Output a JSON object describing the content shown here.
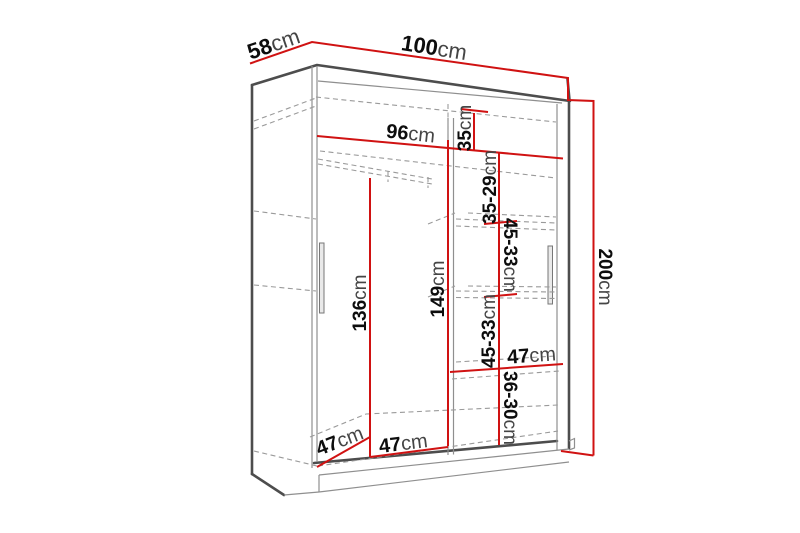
{
  "diagram": {
    "kind": "wardrobe-dimension-drawing",
    "unit": "cm",
    "colors": {
      "dimension_line": "#d01212",
      "outline": "#4d4d4d",
      "thin_line": "#8f8f8f",
      "dashed_line": "#9a9a9a",
      "label_number": "#0d0d0d",
      "label_unit": "#454545",
      "background": "#ffffff"
    },
    "dimensions": {
      "depth": {
        "num": "58",
        "unit": "cm"
      },
      "width": {
        "num": "100",
        "unit": "cm"
      },
      "interior_width": {
        "num": "96",
        "unit": "cm"
      },
      "top_shelf_space": {
        "num": "35",
        "unit": "cm"
      },
      "upper_shelf_space": {
        "num": "35-29",
        "unit": "cm"
      },
      "shelf_space_a": {
        "num": "45-33",
        "unit": "cm"
      },
      "hanging_height": {
        "num": "149",
        "unit": "cm"
      },
      "door_clear_height": {
        "num": "136",
        "unit": "cm"
      },
      "shelf_space_b": {
        "num": "45-33",
        "unit": "cm"
      },
      "total_height": {
        "num": "200",
        "unit": "cm"
      },
      "shelf_width": {
        "num": "47",
        "unit": "cm"
      },
      "bottom_shelf_space": {
        "num": "36-30",
        "unit": "cm"
      },
      "bottom_section_width": {
        "num": "47",
        "unit": "cm"
      },
      "bottom_depth": {
        "num": "47",
        "unit": "cm"
      }
    }
  }
}
